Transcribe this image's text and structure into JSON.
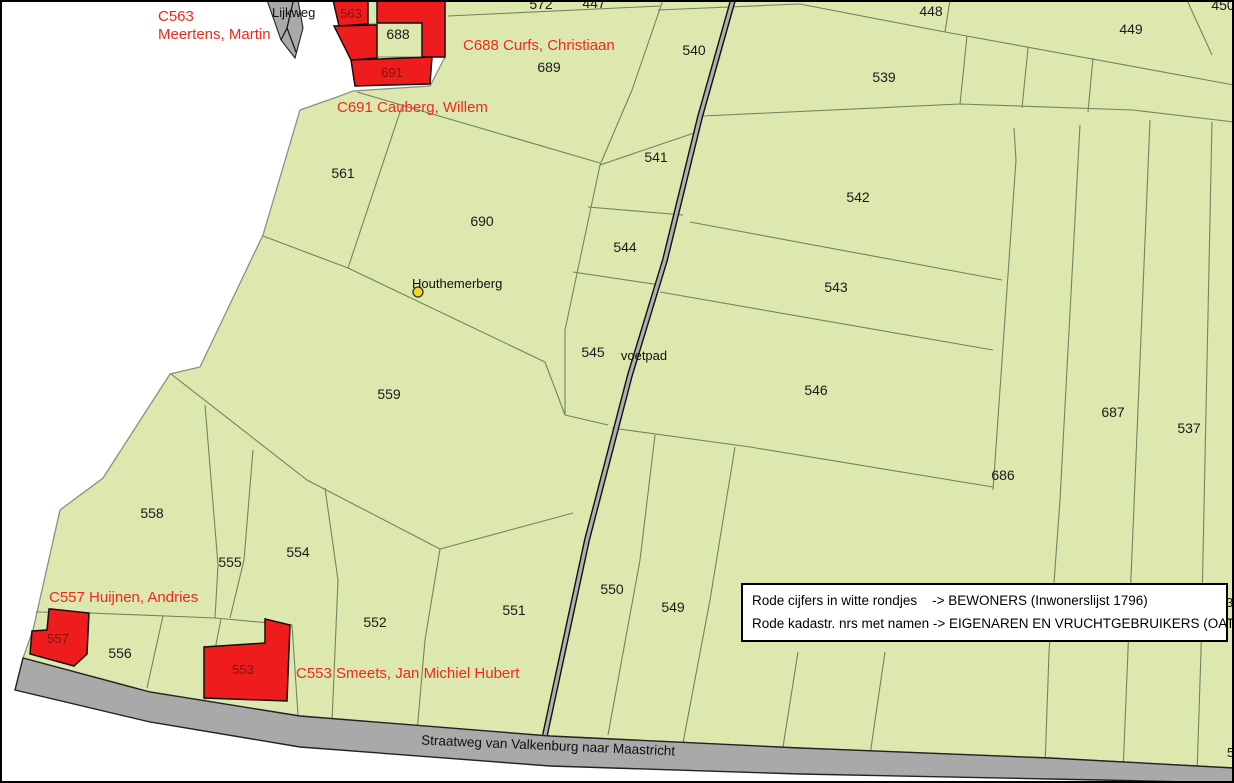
{
  "map": {
    "width": 1234,
    "height": 783,
    "colors": {
      "land": "#dce8ae",
      "parcel_line": "#76825e",
      "outer_line": "#8a9180",
      "road": "#a9a9a9",
      "road_edge": "#222222",
      "voetpad_inner": "#b0b0b0",
      "building": "#ee1c1c",
      "building_text": "#7e140e",
      "owner_text": "#f2281e",
      "parcel_text": "#1a1a1a",
      "poi_dot": "#f6d428"
    },
    "land": {
      "points": [
        [
          445,
          0
        ],
        [
          1234,
          0
        ],
        [
          1234,
          768
        ],
        [
          1050,
          758
        ],
        [
          800,
          748
        ],
        [
          550,
          736
        ],
        [
          300,
          716
        ],
        [
          150,
          692
        ],
        [
          23,
          658
        ],
        [
          33,
          630
        ],
        [
          60,
          510
        ],
        [
          103,
          478
        ],
        [
          170,
          374
        ],
        [
          200,
          367
        ],
        [
          263,
          235
        ],
        [
          300,
          110
        ],
        [
          337,
          97
        ],
        [
          353,
          91
        ],
        [
          430,
          86
        ],
        [
          445,
          57
        ]
      ]
    },
    "parcel_lines": [
      [
        [
          448,
          16
        ],
        [
          660,
          6
        ]
      ],
      [
        [
          658,
          10
        ],
        [
          800,
          4
        ],
        [
          945,
          32
        ],
        [
          1234,
          85
        ]
      ],
      [
        [
          950,
          0
        ],
        [
          945,
          32
        ]
      ],
      [
        [
          1187,
          0
        ],
        [
          1212,
          55
        ]
      ],
      [
        [
          703,
          116
        ],
        [
          960,
          104
        ],
        [
          1133,
          110
        ],
        [
          1234,
          122
        ]
      ],
      [
        [
          967,
          36
        ],
        [
          960,
          104
        ]
      ],
      [
        [
          1028,
          48
        ],
        [
          1022,
          108
        ]
      ],
      [
        [
          1093,
          58
        ],
        [
          1088,
          112
        ]
      ],
      [
        [
          663,
          0
        ],
        [
          632,
          90
        ],
        [
          600,
          165
        ],
        [
          565,
          330
        ],
        [
          565,
          415
        ]
      ],
      [
        [
          600,
          165
        ],
        [
          700,
          131
        ]
      ],
      [
        [
          588,
          207
        ],
        [
          683,
          215
        ]
      ],
      [
        [
          573,
          272
        ],
        [
          660,
          285
        ]
      ],
      [
        [
          565,
          415
        ],
        [
          608,
          425
        ]
      ],
      [
        [
          612,
          428
        ],
        [
          750,
          447
        ],
        [
          993,
          487
        ]
      ],
      [
        [
          690,
          222
        ],
        [
          1002,
          280
        ]
      ],
      [
        [
          660,
          292
        ],
        [
          993,
          350
        ]
      ],
      [
        [
          1014,
          128
        ],
        [
          1016,
          160
        ],
        [
          993,
          490
        ]
      ],
      [
        [
          1080,
          125
        ],
        [
          1060,
          500
        ],
        [
          1049,
          652
        ],
        [
          1045,
          767
        ]
      ],
      [
        [
          1150,
          120
        ],
        [
          1128,
          650
        ],
        [
          1123,
          772
        ]
      ],
      [
        [
          1212,
          122
        ],
        [
          1201,
          652
        ],
        [
          1197,
          773
        ]
      ],
      [
        [
          357,
          92
        ],
        [
          600,
          163
        ]
      ],
      [
        [
          402,
          106
        ],
        [
          348,
          268
        ]
      ],
      [
        [
          263,
          236
        ],
        [
          348,
          268
        ],
        [
          545,
          362
        ],
        [
          565,
          415
        ]
      ],
      [
        [
          171,
          374
        ],
        [
          307,
          480
        ],
        [
          440,
          549
        ]
      ],
      [
        [
          205,
          405
        ],
        [
          218,
          565
        ],
        [
          215,
          618
        ]
      ],
      [
        [
          253,
          450
        ],
        [
          244,
          560
        ],
        [
          230,
          618
        ]
      ],
      [
        [
          325,
          488
        ],
        [
          338,
          580
        ],
        [
          332,
          722
        ]
      ],
      [
        [
          36,
          612
        ],
        [
          90,
          613
        ],
        [
          215,
          618
        ]
      ],
      [
        [
          163,
          616
        ],
        [
          147,
          688
        ]
      ],
      [
        [
          215,
          618
        ],
        [
          292,
          625
        ],
        [
          298,
          715
        ]
      ],
      [
        [
          221,
          619
        ],
        [
          205,
          700
        ]
      ],
      [
        [
          440,
          549
        ],
        [
          425,
          640
        ],
        [
          417,
          732
        ]
      ],
      [
        [
          440,
          549
        ],
        [
          573,
          513
        ]
      ],
      [
        [
          655,
          435
        ],
        [
          640,
          560
        ],
        [
          608,
          735
        ]
      ],
      [
        [
          735,
          447
        ],
        [
          710,
          600
        ],
        [
          683,
          743
        ]
      ],
      [
        [
          798,
          652
        ],
        [
          783,
          747
        ]
      ],
      [
        [
          885,
          652
        ],
        [
          870,
          755
        ]
      ]
    ],
    "roads": {
      "straatweg": {
        "points": [
          [
            23,
            658
          ],
          [
            150,
            692
          ],
          [
            300,
            716
          ],
          [
            550,
            736
          ],
          [
            800,
            748
          ],
          [
            1050,
            758
          ],
          [
            1234,
            768
          ],
          [
            1234,
            783
          ],
          [
            1100,
            780
          ],
          [
            800,
            774
          ],
          [
            550,
            766
          ],
          [
            300,
            747
          ],
          [
            150,
            722
          ],
          [
            15,
            690
          ]
        ]
      },
      "lijkweg": {
        "points": [
          [
            267,
            0
          ],
          [
            298,
            0
          ],
          [
            303,
            28
          ],
          [
            295,
            58
          ],
          [
            281,
            40
          ]
        ],
        "path_lines": [
          [
            [
              293,
              2
            ],
            [
              287,
              28
            ],
            [
              296,
              52
            ]
          ],
          [
            [
              287,
              28
            ],
            [
              281,
              40
            ]
          ]
        ]
      }
    },
    "voetpad": {
      "points": [
        [
          733,
          0
        ],
        [
          700,
          117
        ],
        [
          665,
          260
        ],
        [
          630,
          375
        ],
        [
          587,
          540
        ],
        [
          545,
          735
        ]
      ]
    },
    "courtyards": [
      [
        [
          377,
          23
        ],
        [
          422,
          23
        ],
        [
          422,
          57
        ],
        [
          377,
          57
        ]
      ],
      [
        [
          368,
          0
        ],
        [
          377,
          0
        ],
        [
          377,
          24
        ],
        [
          368,
          24
        ]
      ]
    ],
    "buildings": [
      {
        "id": "563",
        "points": [
          [
            333,
            0
          ],
          [
            368,
            0
          ],
          [
            368,
            24
          ],
          [
            339,
            26
          ]
        ]
      },
      {
        "id": "688-block",
        "points": [
          [
            377,
            0
          ],
          [
            445,
            0
          ],
          [
            445,
            57
          ],
          [
            422,
            57
          ],
          [
            422,
            23
          ],
          [
            377,
            23
          ]
        ]
      },
      {
        "id": "688-left-wing",
        "points": [
          [
            334,
            26
          ],
          [
            377,
            25
          ],
          [
            377,
            58
          ],
          [
            351,
            60
          ]
        ]
      },
      {
        "id": "691",
        "points": [
          [
            351,
            60
          ],
          [
            432,
            57
          ],
          [
            430,
            84
          ],
          [
            355,
            86
          ]
        ]
      },
      {
        "id": "557",
        "points": [
          [
            51,
            609
          ],
          [
            89,
            613
          ],
          [
            87,
            654
          ],
          [
            74,
            666
          ],
          [
            30,
            654
          ],
          [
            32,
            631
          ],
          [
            47,
            630
          ],
          [
            49,
            609
          ]
        ]
      },
      {
        "id": "553",
        "points": [
          [
            265,
            619
          ],
          [
            290,
            625
          ],
          [
            287,
            701
          ],
          [
            204,
            698
          ],
          [
            204,
            647
          ],
          [
            265,
            643
          ]
        ]
      }
    ],
    "poi": {
      "houthemerberg_dot": {
        "x": 418,
        "y": 292,
        "r": 5
      }
    },
    "parcel_labels": [
      {
        "t": "572",
        "x": 541,
        "y": 9
      },
      {
        "t": "447",
        "x": 594,
        "y": 8
      },
      {
        "t": "448",
        "x": 931,
        "y": 16
      },
      {
        "t": "449",
        "x": 1131,
        "y": 34
      },
      {
        "t": "450",
        "x": 1223,
        "y": 10
      },
      {
        "t": "540",
        "x": 694,
        "y": 55
      },
      {
        "t": "539",
        "x": 884,
        "y": 82
      },
      {
        "t": "689",
        "x": 549,
        "y": 72
      },
      {
        "t": "688",
        "x": 398,
        "y": 39
      },
      {
        "t": "561",
        "x": 343,
        "y": 178
      },
      {
        "t": "690",
        "x": 482,
        "y": 226
      },
      {
        "t": "541",
        "x": 656,
        "y": 162
      },
      {
        "t": "544",
        "x": 625,
        "y": 252
      },
      {
        "t": "542",
        "x": 858,
        "y": 202
      },
      {
        "t": "543",
        "x": 836,
        "y": 292
      },
      {
        "t": "545",
        "x": 593,
        "y": 357
      },
      {
        "t": "546",
        "x": 816,
        "y": 395
      },
      {
        "t": "559",
        "x": 389,
        "y": 399
      },
      {
        "t": "687",
        "x": 1113,
        "y": 417
      },
      {
        "t": "537",
        "x": 1189,
        "y": 433
      },
      {
        "t": "686",
        "x": 1003,
        "y": 480
      },
      {
        "t": "558",
        "x": 152,
        "y": 518
      },
      {
        "t": "555",
        "x": 230,
        "y": 567
      },
      {
        "t": "554",
        "x": 298,
        "y": 557
      },
      {
        "t": "556",
        "x": 120,
        "y": 658
      },
      {
        "t": "552",
        "x": 375,
        "y": 627
      },
      {
        "t": "551",
        "x": 514,
        "y": 615
      },
      {
        "t": "550",
        "x": 612,
        "y": 594
      },
      {
        "t": "549",
        "x": 673,
        "y": 612
      }
    ],
    "building_labels": [
      {
        "t": "563",
        "x": 351,
        "y": 18
      },
      {
        "t": "691",
        "x": 392,
        "y": 77
      },
      {
        "t": "557",
        "x": 58,
        "y": 643
      },
      {
        "t": "553",
        "x": 243,
        "y": 674
      }
    ],
    "owner_labels": [
      {
        "id": "C563",
        "x": 158,
        "y": 21,
        "lines": [
          "C563",
          "Meertens, Martin"
        ]
      },
      {
        "id": "C688",
        "x": 463,
        "y": 50,
        "lines": [
          "C688 Curfs, Christiaan"
        ]
      },
      {
        "id": "C691",
        "x": 337,
        "y": 112,
        "lines": [
          "C691 Cauberg, Willem"
        ]
      },
      {
        "id": "C557",
        "x": 49,
        "y": 602,
        "lines": [
          "C557 Huijnen, Andries"
        ]
      },
      {
        "id": "C553",
        "x": 296,
        "y": 678,
        "lines": [
          "C553 Smeets, Jan Michiel Hubert"
        ]
      }
    ],
    "place_labels": [
      {
        "n": "lijkweg-label",
        "t": "Lijkweg",
        "x": 272,
        "y": 17,
        "a": "start",
        "s": 13
      },
      {
        "n": "houthemerberg-label",
        "t": "Houthemerberg",
        "x": 412,
        "y": 288,
        "a": "start",
        "s": 13
      },
      {
        "n": "voetpad-label",
        "t": "voetpad",
        "x": 644,
        "y": 360,
        "a": "middle",
        "s": 13
      },
      {
        "n": "straatweg-label",
        "t": "Straatweg van Valkenburg naar Maastricht",
        "x": 548,
        "y": 750,
        "a": "middle",
        "s": 13.5,
        "r": 2.5
      }
    ],
    "edge_fragments": [
      {
        "t": "36",
        "x": 1226,
        "y": 607
      },
      {
        "t": "5",
        "x": 1227,
        "y": 757
      }
    ],
    "legend": {
      "lines": [
        "Rode cijfers in witte rondjes    -> BEWONERS (Inwonerslijst 1796)",
        "Rode kadastr. nrs met namen -> EIGENAREN EN VRUCHTGEBRUIKERS (OAT 1842)"
      ]
    }
  }
}
